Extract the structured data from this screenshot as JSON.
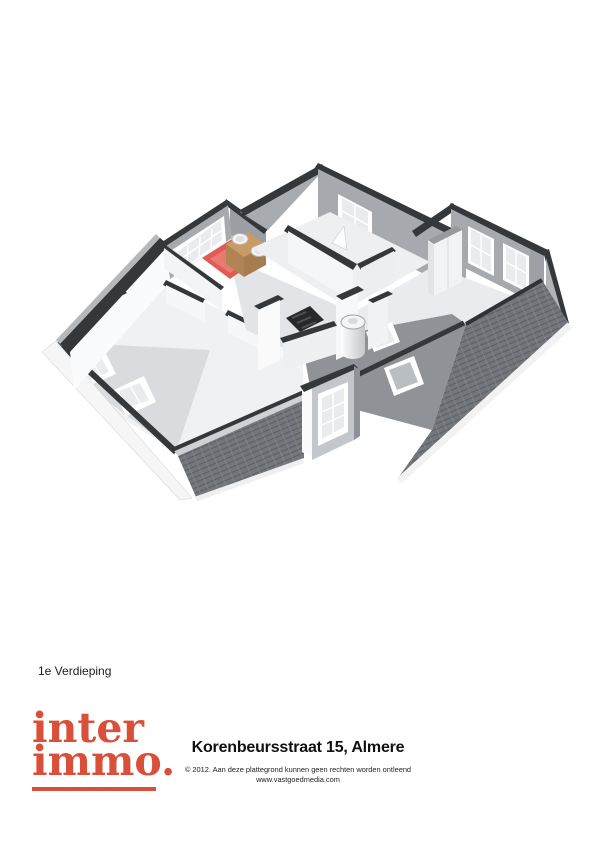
{
  "floor_label": "1e Verdieping",
  "logo": {
    "line1": "inter",
    "line2": "immo."
  },
  "footer": {
    "title": "Korenbeursstraat 15, Almere",
    "copyright": "© 2012. Aan deze plattegrond kunnen geen rechten worden ontleend",
    "website": "www.vastgoedmedia.com"
  },
  "floorplan": {
    "type": "3d-isometric-floorplan",
    "features": [
      "bathroom-red-floor",
      "wood-vanity-two-sinks",
      "gridded-bathroom-window",
      "landing-window",
      "right-bedroom-two-windows",
      "wardrobe-closet",
      "boiler-cylinder",
      "stair-opening",
      "dormer-window",
      "four-roof-skylights",
      "tiled-roof-left",
      "tiled-roof-right"
    ]
  },
  "colors": {
    "logo-red": "#d94f3a",
    "wall-top": "#35383b",
    "tile-bg": "#73777b",
    "tile-line": "#5c6064",
    "tile-line2": "#84888c",
    "bath-red": "#e25a55",
    "bath-red-light": "#e87a70",
    "wood": "#c99c66",
    "wood-front": "#a87d4d",
    "wood-side": "#b08454",
    "glass": "#e8ecef",
    "slope-dark": "#8f9296",
    "slope-light": "#d9dbde",
    "wall-gray": "#a6aaae",
    "floor-white": "#f0f1f3"
  }
}
